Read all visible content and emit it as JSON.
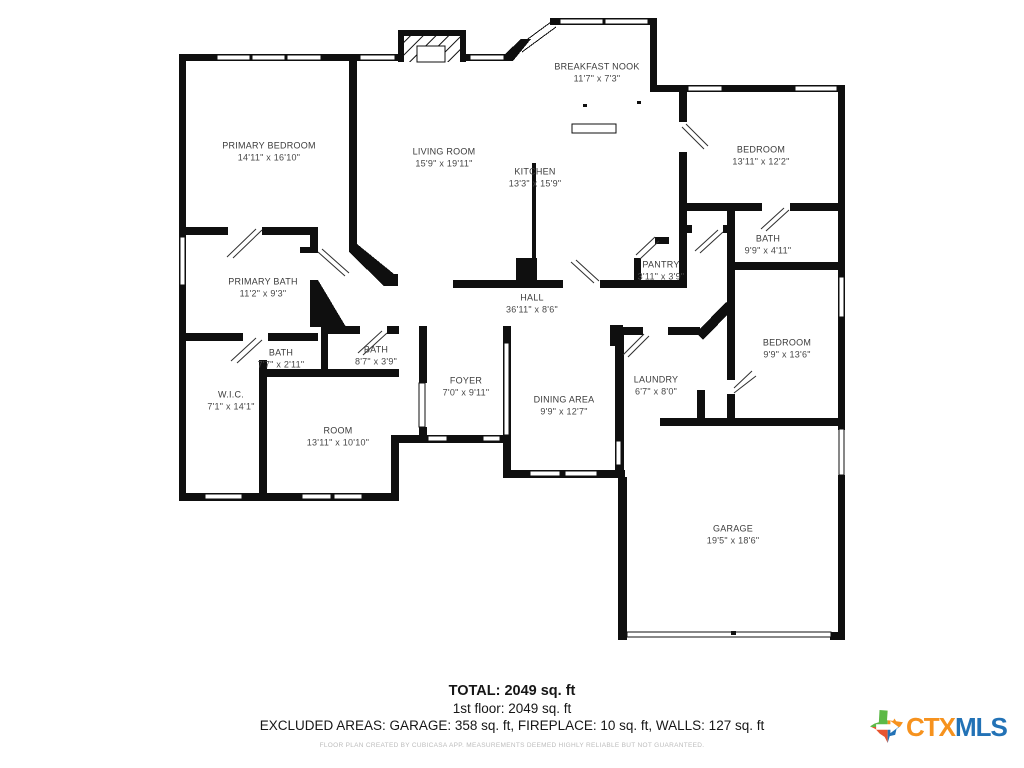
{
  "floor_plan": {
    "rooms": [
      {
        "name": "BREAKFAST NOOK",
        "dims": "11'7\" x 7'3\"",
        "x": 597,
        "y": 73
      },
      {
        "name": "PRIMARY BEDROOM",
        "dims": "14'11\" x 16'10\"",
        "x": 269,
        "y": 152
      },
      {
        "name": "LIVING ROOM",
        "dims": "15'9\" x 19'11\"",
        "x": 444,
        "y": 158
      },
      {
        "name": "BEDROOM",
        "dims": "13'11\" x 12'2\"",
        "x": 761,
        "y": 156
      },
      {
        "name": "KITCHEN",
        "dims": "13'3\" x 15'9\"",
        "x": 535,
        "y": 178
      },
      {
        "name": "BATH",
        "dims": "9'9\" x 4'11\"",
        "x": 768,
        "y": 245
      },
      {
        "name": "PANTRY",
        "dims": "3'11\" x 3'9\"",
        "x": 661,
        "y": 271
      },
      {
        "name": "PRIMARY BATH",
        "dims": "11'2\" x 9'3\"",
        "x": 263,
        "y": 288
      },
      {
        "name": "HALL",
        "dims": "36'11\" x 8'6\"",
        "x": 532,
        "y": 304
      },
      {
        "name": "BEDROOM",
        "dims": "9'9\" x 13'6\"",
        "x": 787,
        "y": 349
      },
      {
        "name": "BATH",
        "dims": "8'7\" x 3'9\"",
        "x": 376,
        "y": 356
      },
      {
        "name": "BATH",
        "dims": "7'7\" x 2'11\"",
        "x": 281,
        "y": 359
      },
      {
        "name": "LAUNDRY",
        "dims": "6'7\" x 8'0\"",
        "x": 656,
        "y": 386
      },
      {
        "name": "FOYER",
        "dims": "7'0\" x 9'11\"",
        "x": 466,
        "y": 387
      },
      {
        "name": "W.I.C.",
        "dims": "7'1\" x 14'1\"",
        "x": 231,
        "y": 401
      },
      {
        "name": "DINING AREA",
        "dims": "9'9\" x 12'7\"",
        "x": 564,
        "y": 406
      },
      {
        "name": "ROOM",
        "dims": "13'11\" x 10'10\"",
        "x": 338,
        "y": 437
      },
      {
        "name": "GARAGE",
        "dims": "19'5\" x 18'6\"",
        "x": 733,
        "y": 535
      }
    ]
  },
  "summary": {
    "total": "TOTAL: 2049 sq. ft",
    "floor1": "1st floor: 2049 sq. ft",
    "excluded": "EXCLUDED AREAS: GARAGE: 358 sq. ft, FIREPLACE: 10 sq. ft, WALLS: 127 sq. ft",
    "disclaimer": "FLOOR PLAN CREATED BY CUBICASA APP. MEASUREMENTS DEEMED HIGHLY RELIABLE BUT NOT GUARANTEED."
  },
  "logo": {
    "ctx": "CTX",
    "mls": "MLS",
    "ctx_color": "#F6921E",
    "mls_color": "#2272B6",
    "texas_colors": {
      "top_left": "#5CB947",
      "top_right": "#F6921E",
      "bottom_left": "#E8542F",
      "bottom_right": "#2272B6"
    }
  },
  "colors": {
    "walls": "#0f0f0f",
    "label_text": "#3b3b3b",
    "disclaimer_text": "#bcbcbc"
  }
}
